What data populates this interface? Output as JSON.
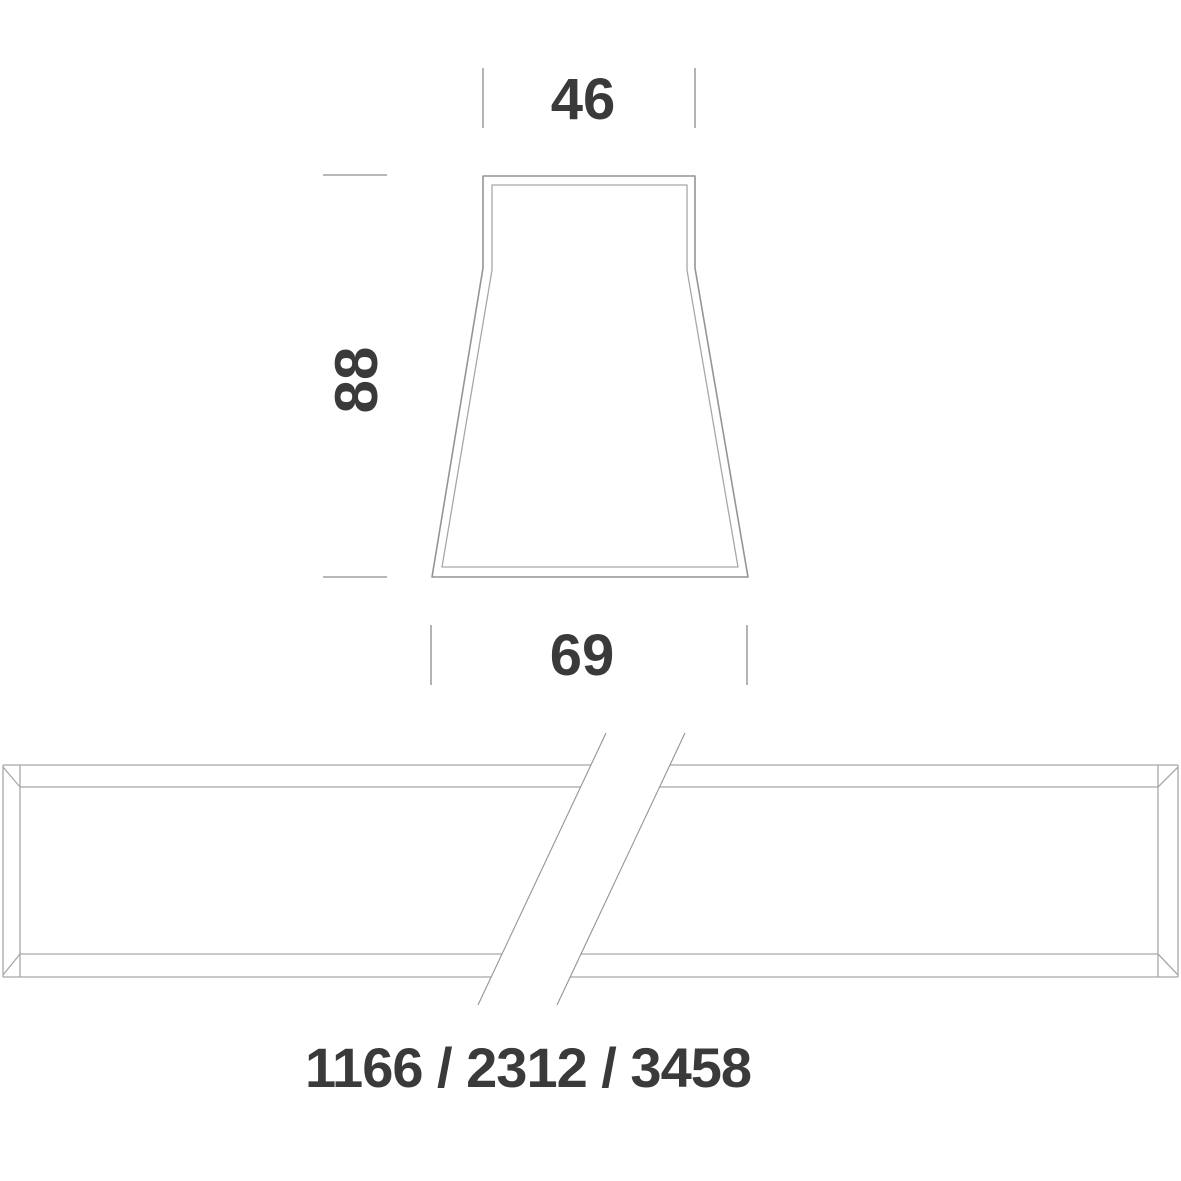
{
  "drawing": {
    "cross_section": {
      "top_width_label": "46",
      "height_label": "88",
      "bottom_width_label": "69"
    },
    "side_elevation": {
      "length_label": "1166 / 2312 / 3458"
    },
    "colors": {
      "line": "#949494",
      "line_light": "#a8a8a8",
      "tick": "#a2a2a2",
      "text": "#3a3a3a",
      "background": "#ffffff"
    }
  }
}
